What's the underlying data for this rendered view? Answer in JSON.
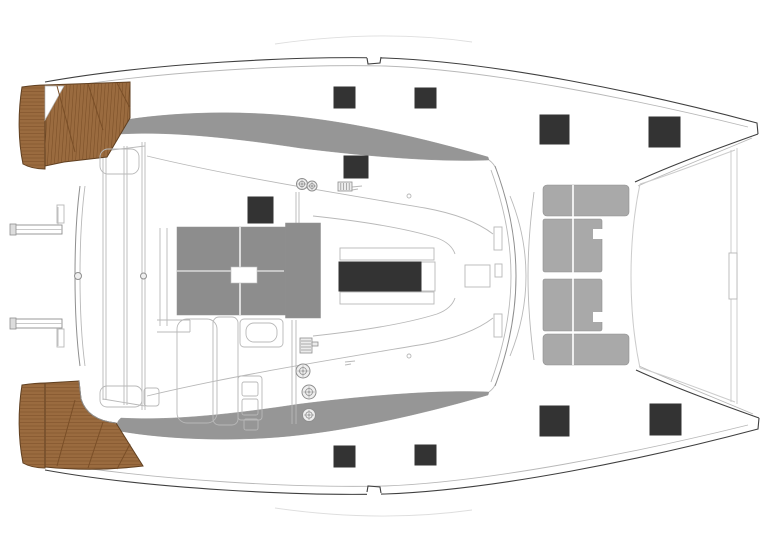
{
  "title": "Catamaran deck layout plan — top view",
  "colors": {
    "outline": "#3f3f3f",
    "mid": "#8f8f8f",
    "light": "#b8b8b8",
    "faint": "#dedede",
    "trampoline_line": "#cccccc",
    "teak": "#9a6b3f",
    "teak_line": "#7a4f28",
    "teak_edge": "#5f3f20",
    "hatch_black": "#333333",
    "table_gray": "#8d8d8d",
    "band_gray": "#969696",
    "cushion_gray": "#a9a9a9",
    "winch_fill": "#efefef"
  },
  "deck_hatches": [
    {
      "name": "hatch-coachroof-port-aft",
      "x": 334,
      "y": 87,
      "w": 21,
      "h": 21
    },
    {
      "name": "hatch-coachroof-port-fwd",
      "x": 415,
      "y": 88,
      "w": 21,
      "h": 20
    },
    {
      "name": "hatch-coachroof-front",
      "x": 344,
      "y": 156,
      "w": 24,
      "h": 22
    },
    {
      "name": "hatch-galley",
      "x": 248,
      "y": 197,
      "w": 25,
      "h": 26
    },
    {
      "name": "hatch-foredeck-port-aft",
      "x": 540,
      "y": 115,
      "w": 29,
      "h": 29
    },
    {
      "name": "hatch-foredeck-port-fwd",
      "x": 649,
      "y": 117,
      "w": 31,
      "h": 30
    },
    {
      "name": "hatch-coachroof-stbd-aft",
      "x": 334,
      "y": 446,
      "w": 21,
      "h": 21
    },
    {
      "name": "hatch-coachroof-stbd-fwd",
      "x": 415,
      "y": 445,
      "w": 21,
      "h": 20
    },
    {
      "name": "hatch-foredeck-stbd-aft",
      "x": 540,
      "y": 406,
      "w": 29,
      "h": 30
    },
    {
      "name": "hatch-foredeck-stbd-fwd",
      "x": 650,
      "y": 404,
      "w": 31,
      "h": 31
    }
  ],
  "saloon_skylight": {
    "name": "saloon-skylight",
    "x": 339,
    "y": 262,
    "w": 82,
    "h": 29
  },
  "cockpit_table": {
    "main": {
      "x": 177,
      "y": 227,
      "w": 143,
      "h": 88
    },
    "right_section": {
      "x": 285.5,
      "y": 223,
      "w": 35,
      "h": 95
    },
    "seams_v": [
      240
    ],
    "seams_h": [
      271
    ],
    "sink": {
      "x": 231,
      "y": 267,
      "w": 26,
      "h": 16
    }
  },
  "forward_seating": {
    "cells": [
      {
        "name": "fwd-seat-arm-aft",
        "x": 543,
        "y": 185,
        "w": 86,
        "h": 31,
        "rx": 4
      },
      {
        "name": "fwd-seat-mid-1",
        "x": 543,
        "y": 219,
        "w": 59,
        "h": 53,
        "rx": 2
      },
      {
        "name": "fwd-seat-mid-2",
        "x": 543,
        "y": 279,
        "w": 59,
        "h": 52,
        "rx": 2
      },
      {
        "name": "fwd-seat-arm-fwd",
        "x": 543,
        "y": 334,
        "w": 86,
        "h": 31,
        "rx": 4
      }
    ],
    "seam_x": 573,
    "seam_y1": 185,
    "seam_y2": 365,
    "notches": [
      {
        "x": 593,
        "y": 229,
        "w": 10,
        "h": 10
      },
      {
        "x": 593,
        "y": 312,
        "w": 10,
        "h": 10
      }
    ]
  },
  "winches": {
    "helm_bank": [
      {
        "name": "winch-helm-1",
        "cx": 303,
        "cy": 371,
        "r": 7
      },
      {
        "name": "winch-helm-2",
        "cx": 309,
        "cy": 392,
        "r": 7
      },
      {
        "name": "winch-helm-3",
        "cx": 309,
        "cy": 415,
        "r": 6.5
      }
    ],
    "coachroof_pair": [
      {
        "name": "winch-coachroof-1",
        "cx": 302,
        "cy": 184,
        "r": 5.5
      },
      {
        "name": "winch-coachroof-2",
        "cx": 312,
        "cy": 186,
        "r": 5
      }
    ]
  },
  "clutches": [
    {
      "name": "clutch-bank-helm",
      "x": 300,
      "y": 338,
      "w": 12,
      "h": 15,
      "ribs": 4,
      "dir": "h",
      "arm": {
        "x": 312,
        "y": 342,
        "w": 6,
        "h": 4
      }
    },
    {
      "name": "clutch-bank-coachroof",
      "x": 338,
      "y": 182,
      "w": 14,
      "h": 9,
      "ribs": 4,
      "dir": "v"
    }
  ],
  "mast_step": {
    "name": "mast-step",
    "x": 465,
    "y": 265,
    "w": 25,
    "h": 22
  },
  "trampoline_fitting": {
    "name": "bowsprit-fitting",
    "x": 729,
    "y": 253,
    "w": 8,
    "h": 46
  },
  "helm_seats": [
    {
      "name": "helm-seat-port",
      "x": 100,
      "y": 149,
      "w": 39,
      "h": 25,
      "rx": 8
    },
    {
      "name": "helm-seat-stbd",
      "x": 100,
      "y": 386,
      "w": 42,
      "h": 21,
      "rx": 7
    },
    {
      "name": "helm-seat-stbd-step",
      "x": 144,
      "y": 388,
      "w": 15,
      "h": 18,
      "rx": 3
    }
  ],
  "davits": [
    {
      "name": "davit-arm-upper",
      "x": 12,
      "y": 225,
      "w": 50,
      "h": 9
    },
    {
      "name": "davit-arm-lower",
      "x": 12,
      "y": 319,
      "w": 50,
      "h": 9
    }
  ],
  "swim_platforms": {
    "hatch_spacing": 3.5,
    "port": {
      "strip_y1": 88,
      "strip_y2": 168,
      "main_x1": 46,
      "main_x2": 132
    },
    "starboard": {
      "strip_y1": 384,
      "strip_y2": 470,
      "main_y1": 384,
      "main_y2": 472
    }
  }
}
